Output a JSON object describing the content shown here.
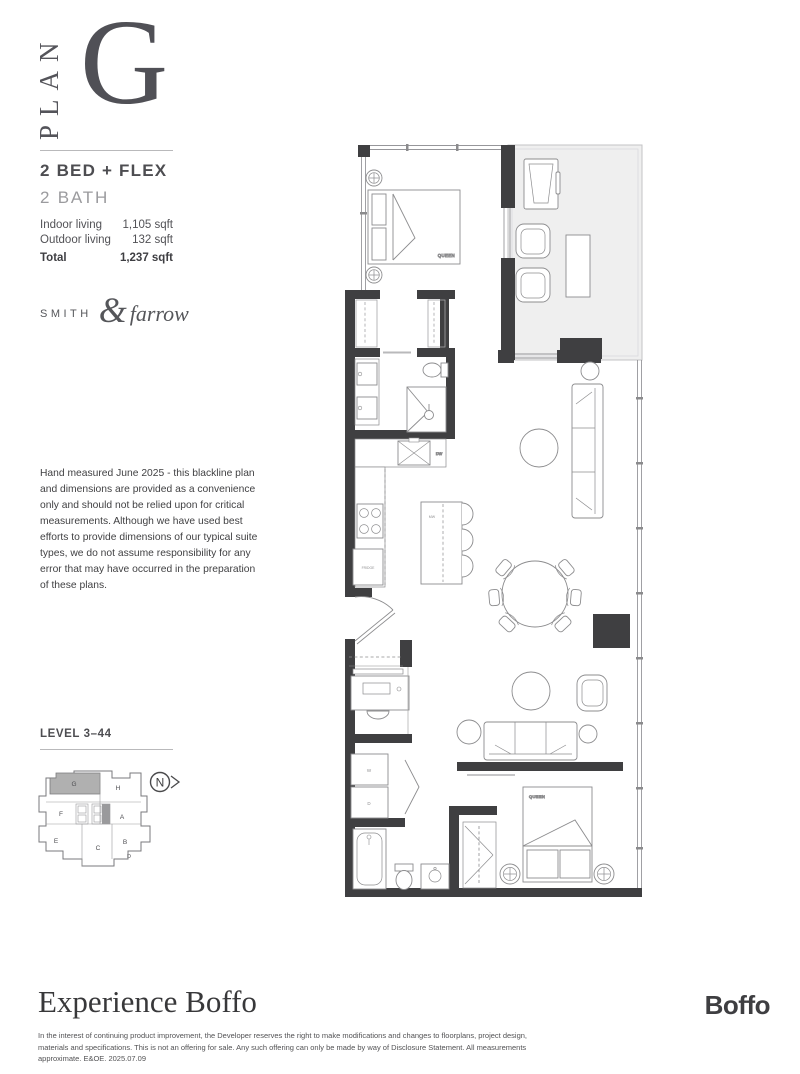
{
  "header": {
    "plan_word": "PLAN",
    "plan_letter": "G"
  },
  "summary": {
    "type_line1": "2 BED + FLEX",
    "type_line2": "2 BATH",
    "stats": [
      {
        "label": "Indoor living",
        "value": "1,105 sqft"
      },
      {
        "label": "Outdoor living",
        "value": "132 sqft"
      },
      {
        "label": "Total",
        "value": "1,237 sqft"
      }
    ]
  },
  "brand": {
    "word1": "SMITH",
    "amp": "&",
    "word2": "farrow"
  },
  "disclaimer": "Hand measured June 2025 - this blackline plan and dimensions are provided as a convenience only and should not be relied upon for critical measurements. Although we have used best efforts to provide dimensions of our typical suite types, we do not assume responsibility for any error that may have occurred in the preparation of these plans.",
  "keyplan": {
    "level_label": "LEVEL 3–44",
    "highlighted_unit": "G",
    "north_label": "N",
    "units": {
      "g": "G",
      "h": "H",
      "f": "F",
      "a": "A",
      "e": "E",
      "c": "C",
      "b": "B",
      "d": "D"
    }
  },
  "floorplan": {
    "labels": {
      "bed1": "QUEEN",
      "bed2": "QUEEN",
      "dishwasher": "DW",
      "microwave": "MW",
      "fridge": "FRIDGE",
      "washer": "W",
      "dryer": "D"
    }
  },
  "footer": {
    "tagline": "Experience Boffo",
    "legal_line": "In the interest of continuing product improvement, the Developer reserves the right to make modifications and changes to floorplans, project design, materials and specifications. This is not an offering for sale. Any such offering can only be made by way of Disclosure Statement. All measurements approximate. E&OE. 2025.07.09",
    "logo": "Boffo"
  },
  "colors": {
    "wall": "#3f3f41",
    "balcony": "#efefef",
    "keyplan_highlight": "#b0b0b0"
  }
}
